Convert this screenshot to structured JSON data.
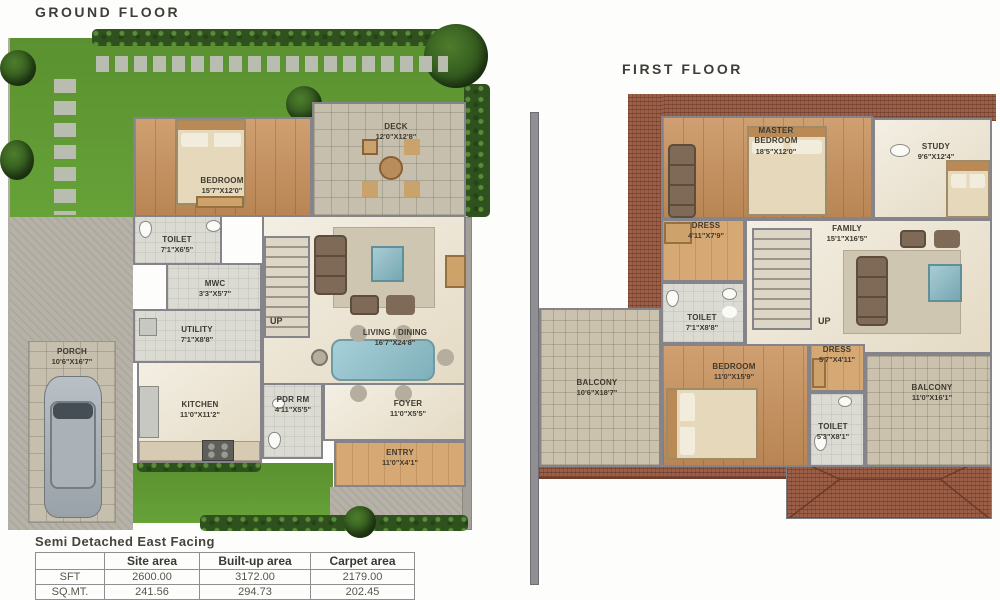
{
  "ground_floor": {
    "title": "GROUND FLOOR",
    "up_label": "UP",
    "rooms": [
      {
        "name": "BEDROOM",
        "dims": "15'7\"X12'0\""
      },
      {
        "name": "DECK",
        "dims": "12'0\"X12'8\""
      },
      {
        "name": "TOILET",
        "dims": "7'1\"X6'5\""
      },
      {
        "name": "MWC",
        "dims": "3'3\"X5'7\""
      },
      {
        "name": "UTILITY",
        "dims": "7'1\"X8'8\""
      },
      {
        "name": "KITCHEN",
        "dims": "11'0\"X11'2\""
      },
      {
        "name": "PDR RM",
        "dims": "4'11\"X5'5\""
      },
      {
        "name": "LIVING / DINING",
        "dims": "16'7\"X24'8\""
      },
      {
        "name": "FOYER",
        "dims": "11'0\"X5'5\""
      },
      {
        "name": "ENTRY",
        "dims": "11'0\"X4'1\""
      },
      {
        "name": "PORCH",
        "dims": "10'6\"X16'7\""
      }
    ]
  },
  "first_floor": {
    "title": "FIRST FLOOR",
    "up_label": "UP",
    "rooms": [
      {
        "name": "MASTER BEDROOM",
        "dims": "18'5\"X12'0\""
      },
      {
        "name": "STUDY",
        "dims": "9'6\"X12'4\""
      },
      {
        "name": "DRESS",
        "dims": "4'11\"X7'9\""
      },
      {
        "name": "FAMILY",
        "dims": "15'1\"X16'5\""
      },
      {
        "name": "TOILET",
        "dims": "7'1\"X8'8\""
      },
      {
        "name": "BEDROOM",
        "dims": "11'0\"X15'9\""
      },
      {
        "name": "DRESS",
        "dims": "5'7\"X4'11\""
      },
      {
        "name": "TOILET",
        "dims": "5'3\"X8'1\""
      },
      {
        "name": "BALCONY",
        "dims": "10'6\"X18'7\""
      },
      {
        "name": "BALCONY",
        "dims": "11'0\"X16'1\""
      }
    ]
  },
  "summary": {
    "title": "Semi Detached East Facing",
    "headers": [
      "",
      "Site area",
      "Built-up area",
      "Carpet area"
    ],
    "rows": [
      {
        "label": "SFT",
        "values": [
          "2600.00",
          "3172.00",
          "2179.00"
        ]
      },
      {
        "label": "SQ.MT.",
        "values": [
          "241.56",
          "294.73",
          "202.45"
        ]
      }
    ]
  },
  "palette": {
    "lawn_green": "#60992f",
    "hedge_green": "#2e511e",
    "roof_brick": "#9b5f48",
    "wall_grey": "#84848a",
    "wood_floor": "#c8905a",
    "paving_grey": "#b6b2a8",
    "accent_teal": "#7fb0ba"
  }
}
